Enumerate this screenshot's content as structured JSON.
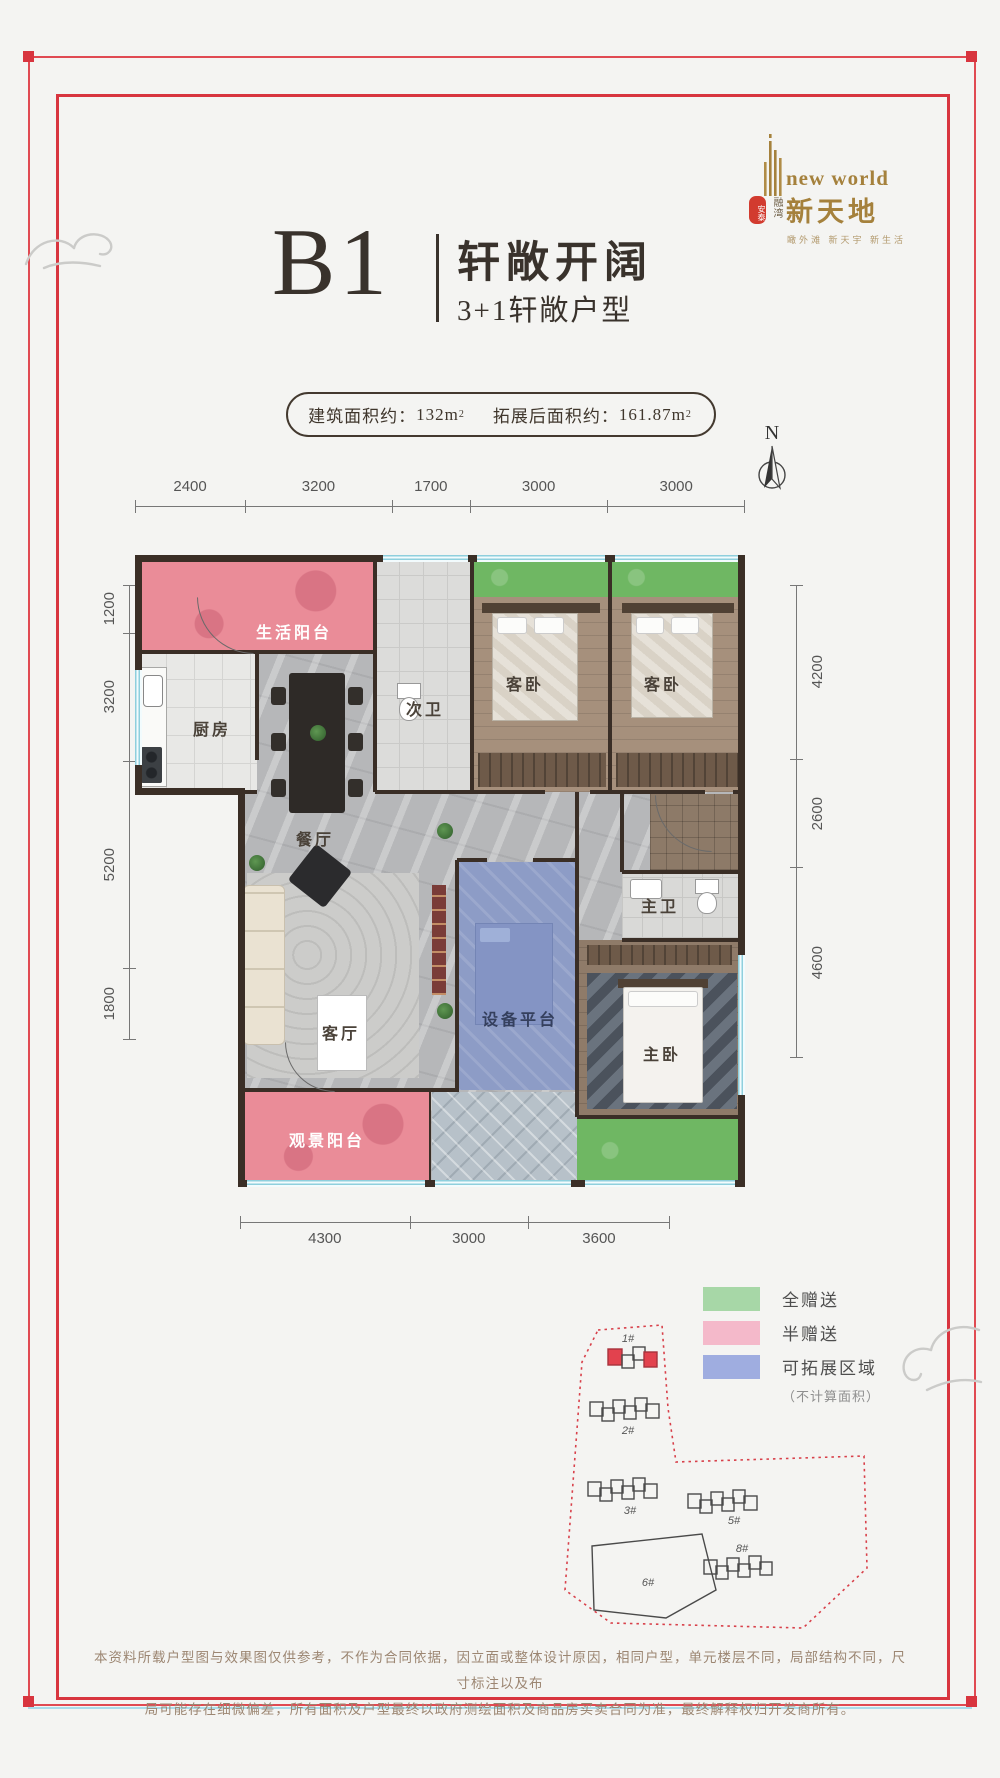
{
  "logo": {
    "brand_en": "new world",
    "brand_cn": "新天地",
    "seal_main": "安泰",
    "seal_side": "融湾",
    "tagline": "瞰外滩 新天宇 新生活"
  },
  "title": {
    "code": "B1",
    "name": "轩敞开阔",
    "sub": "3+1轩敞户型"
  },
  "badge": {
    "left_label": "建筑面积约：",
    "left_value": "132m",
    "right_label": "拓展后面积约：",
    "right_value": "161.87m",
    "sup": "2"
  },
  "compass": {
    "n": "N"
  },
  "dims": {
    "top": [
      "2400",
      "3200",
      "1700",
      "3000",
      "3000"
    ],
    "left": [
      "1200",
      "3200",
      "5200",
      "1800"
    ],
    "right": [
      "4200",
      "2600",
      "4600"
    ],
    "bottom": [
      "4300",
      "3000",
      "3600"
    ]
  },
  "rooms": {
    "life_balcony": "生活阳台",
    "kitchen": "厨房",
    "dining": "餐厅",
    "guest_bath": "次卫",
    "bedroom_a": "客卧",
    "bedroom_b": "客卧",
    "master_bath": "主卫",
    "living": "客厅",
    "equipment": "设备平台",
    "master": "主卧",
    "view_balcony": "观景阳台"
  },
  "legend": {
    "items": [
      {
        "label": "全赠送",
        "color": "#a7d7a7"
      },
      {
        "label": "半赠送",
        "color": "#f4b9ca"
      },
      {
        "label": "可拓展区域",
        "color": "#9fade0"
      }
    ],
    "note": "（不计算面积）"
  },
  "siteplan": {
    "buildings": [
      "1#",
      "2#",
      "3#",
      "5#",
      "6#",
      "8#"
    ]
  },
  "disclaimer": {
    "line1": "本资料所载户型图与效果图仅供参考，不作为合同依据，因立面或整体设计原因，相同户型，单元楼层不同，局部结构不同，尺寸标注以及布",
    "line2": "局可能存在细微偏差，所有面积及户型最终以政府测绘面积及商品房买卖合同为准，最终解释权归开发商所有。"
  },
  "colors": {
    "accent_red": "#d8353f",
    "gold": "#a5813c",
    "wall": "#3a2e26",
    "window_cyan": "#8fcfdd",
    "balcony_pink": "#ea8c98",
    "gift_green": "#6fb763",
    "expand_blue": "#8d9cc6"
  }
}
